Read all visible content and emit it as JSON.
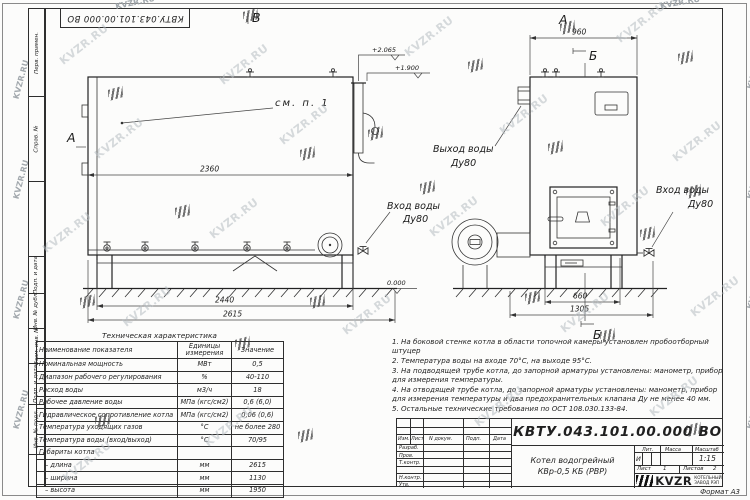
{
  "watermark": {
    "text": "KVZR.RU"
  },
  "stamp": {
    "designation": "КВТУ.043.101.00.000 ВО"
  },
  "frame": {
    "left_labels": [
      "Перв. примен.",
      "Справ. №",
      "Подп. и дата",
      "Инв. № дубл.",
      "Взам. инв. №",
      "Подп. и дата",
      "Инв. № подл."
    ]
  },
  "drawing": {
    "markers": {
      "section_b_front": "В",
      "section_a_front": "А",
      "section_a_side": "А",
      "section_b_side_top": "Б",
      "section_b_side_bottom": "Б"
    },
    "callouts": {
      "see_note": "см. п. 1",
      "water_outlet": "Выход воды",
      "water_outlet_dn": "Ду80",
      "water_inlet_front": "Вход воды",
      "water_inlet_front_dn": "Ду80",
      "water_inlet_side": "Вход воды",
      "water_inlet_side_dn": "Ду80"
    },
    "elevations": {
      "top": "+2.065",
      "nozzle": "+1.900",
      "ground": "0.000"
    },
    "dims": {
      "front_inner": "2360",
      "front_frame": "2440",
      "front_overall": "2615",
      "side_top": "960",
      "side_frame": "660",
      "side_overall": "1305"
    }
  },
  "table": {
    "title": "Техническая характеристика",
    "headers": [
      "Наименование показателя",
      "Единицы измерения",
      "Значение"
    ],
    "rows": [
      {
        "name": "Номинальная мощность",
        "units": "МВт",
        "value": "0,5"
      },
      {
        "name": "Диапазон рабочего регулирования",
        "units": "%",
        "value": "40-110"
      },
      {
        "name": "Расход воды",
        "units": "м3/ч",
        "value": "18"
      },
      {
        "name": "Рабочее давление воды",
        "units": "МПа (кгс/см2)",
        "value": "0,6 (6,0)"
      },
      {
        "name": "Гидравлическое сопротивление котла",
        "units": "МПа (кгс/см2)",
        "value": "0,06 (0,6)"
      },
      {
        "name": "Температура уходящих газов",
        "units": "°С",
        "value": "не более 280"
      },
      {
        "name": "Температура воды (вход/выход)",
        "units": "°С",
        "value": "70/95"
      },
      {
        "name": "Габариты котла",
        "units": "",
        "value": ""
      },
      {
        "name": "– длина",
        "units": "мм",
        "value": "2615"
      },
      {
        "name": "– ширина",
        "units": "мм",
        "value": "1130"
      },
      {
        "name": "– высота",
        "units": "мм",
        "value": "1950"
      }
    ]
  },
  "notes": [
    "1.  На боковой стенке котла в области топочной камеры установлен пробоотборный штуцер",
    "2.  Температура воды на входе 70°С, на выходе 95°С.",
    "3.  На подводящей трубе котла, до запорной арматуры установлены: манометр, прибор для измерения температуры.",
    "4.  На отводящей трубе котла, до запорной арматуры установлены: манометр, прибор для измерения температуры и два предохранительных клапана Ду не менее 40 мм.",
    "5.  Остальные технические требования по ОСТ 108.030.133-84."
  ],
  "title_block": {
    "designation": "КВТУ.043.101.00.000  ВО",
    "product_name_line1": "Котел водогрейный",
    "product_name_line2": "КВр-0,5 КБ (РВР)",
    "header_cells": [
      "Изм.",
      "Лист",
      "N докум.",
      "Подп.",
      "Дата"
    ],
    "row_labels": [
      "Разраб.",
      "Пров.",
      "Т.контр.",
      "Н.контр.",
      "Утв."
    ],
    "lit_label": "Лит.",
    "mass_label": "Масса",
    "scale_label": "Масштаб",
    "lit_value": "И",
    "scale_value": "1:15",
    "sheet_label": "Лист",
    "sheet_value": "1",
    "sheets_label": "Листов",
    "sheets_value": "2",
    "logo_text": "KVZR",
    "logo_sub1": "КОТЕЛЬНЫЙ",
    "logo_sub2": "ЗАВОД РЭП",
    "format": "Формат  А3"
  }
}
